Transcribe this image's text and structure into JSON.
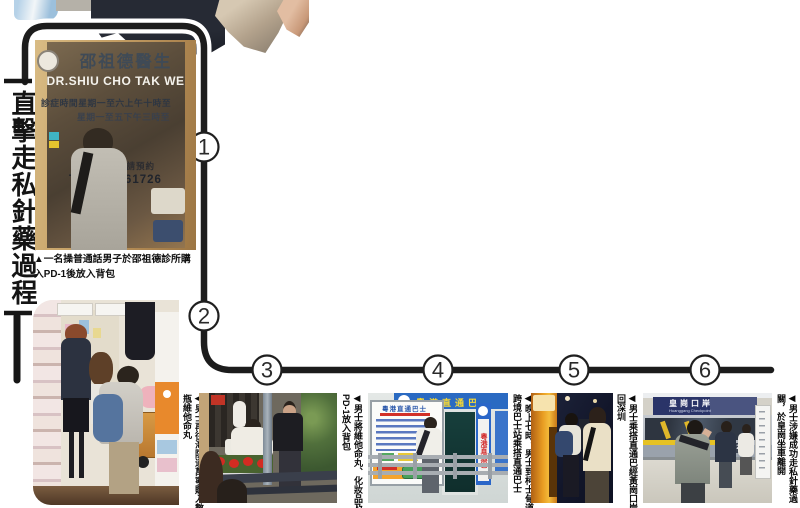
{
  "title": {
    "text": "直擊走私針藥過程"
  },
  "steps": [
    "1",
    "2",
    "3",
    "4",
    "5",
    "6"
  ],
  "captions": {
    "clinic": "▲一名操普通話男子於邵祖德診所購入PD-1後放入背包",
    "store": "◀男士再往海防道萬寧購入數瓶維他命丸",
    "street": "◀男士將維他命丸、化妝品及PD-1放入背包",
    "terminal": "◀晚上七時，男士到柯士甸道跨境巴士站乘搭直通巴士",
    "nightbus": "◀男士乘搭直通巴經黃崗口岸回深圳",
    "checkpoint": "◀男士涉嫌成功走私針藥過關，於皇崗坐車離開"
  },
  "photo_text": {
    "clinic": {
      "name_cn": "邵祖德醫生",
      "name_en": "DR.SHIU CHO TAK WE",
      "hours1": "診症時間星期一至六上午十時至",
      "hours2": "星期一至五下午三時至",
      "note": "其他時間敬請預約",
      "tel": "TEL: 25861726"
    },
    "terminal": {
      "sign_top": "粵港直通巴",
      "poster_title": "粵港直通巴士",
      "banner": "粵港直通巴"
    },
    "checkpoint": {
      "sign_cn": "皇崗口岸",
      "sign_en": "Huanggang Checkpoint",
      "bus_no": "7241"
    }
  },
  "colors": {
    "connector_line": "#1c1c1c",
    "terminal_blue": "#2a6ac2",
    "poster_orange": "#f4a42e",
    "checkpoint_navy": "#2a3468",
    "bus_yellow": "#e89c22"
  }
}
